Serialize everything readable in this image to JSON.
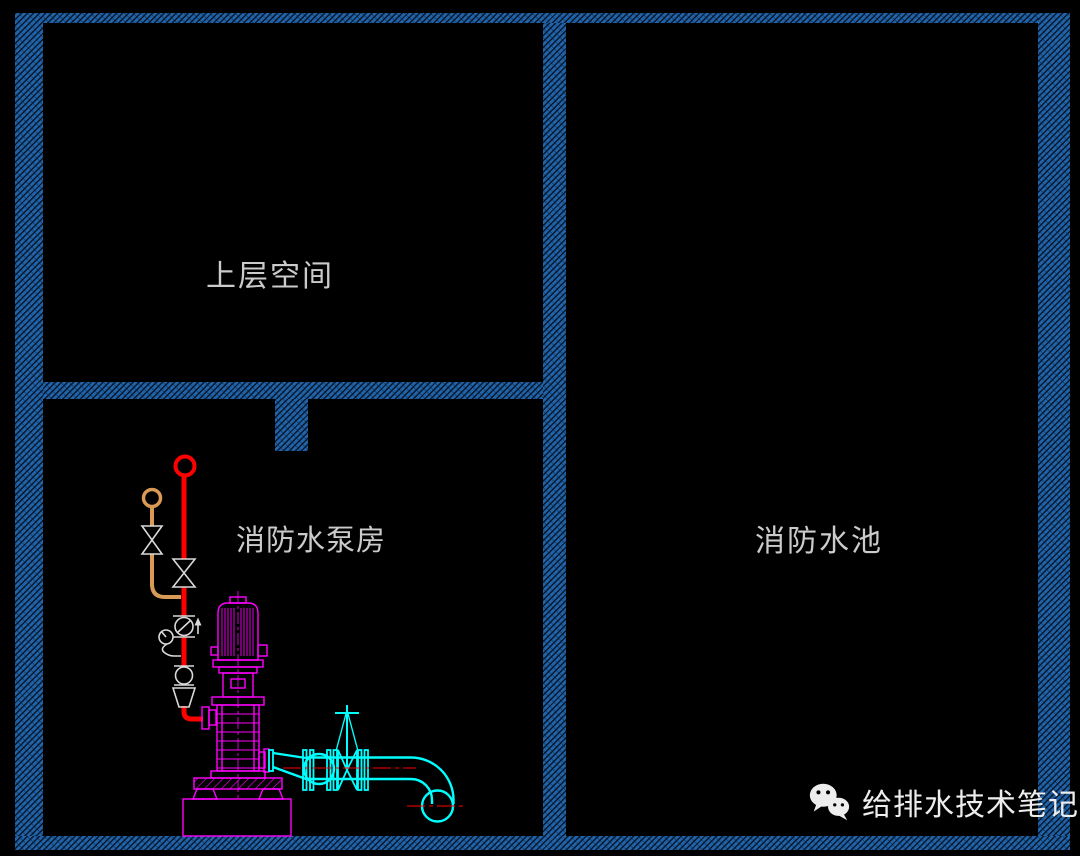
{
  "canvas": {
    "width": 1080,
    "height": 856
  },
  "rooms": [
    {
      "name": "upper-space",
      "label": "上层空间"
    },
    {
      "name": "fire-pump-room",
      "label": "消防水泵房"
    },
    {
      "name": "fire-water-tank",
      "label": "消防水池"
    }
  ],
  "watermark": {
    "text": "给排水技术笔记",
    "icon": "wechat-logo"
  },
  "drawing_elements": {
    "pump": "vertical-multistage-fire-pump",
    "discharge_pipe_color_meaning": "pipe-red",
    "bypass_pipe_color_meaning": "pipe-orange",
    "suction_pipe_color_meaning": "pipe-cyan"
  },
  "colors": {
    "bg": "#000000",
    "wall-fill": "#2063a8",
    "wall-line": "#08182e",
    "label-text": "#d6d6d6",
    "watermark-text": "#ededed",
    "pipe-red": "#ff0000",
    "pipe-orange": "#d89a55",
    "pipe-cyan": "#00ffff",
    "pump-magenta": "#ff00ff",
    "fitting-white": "#d9d9d9"
  }
}
